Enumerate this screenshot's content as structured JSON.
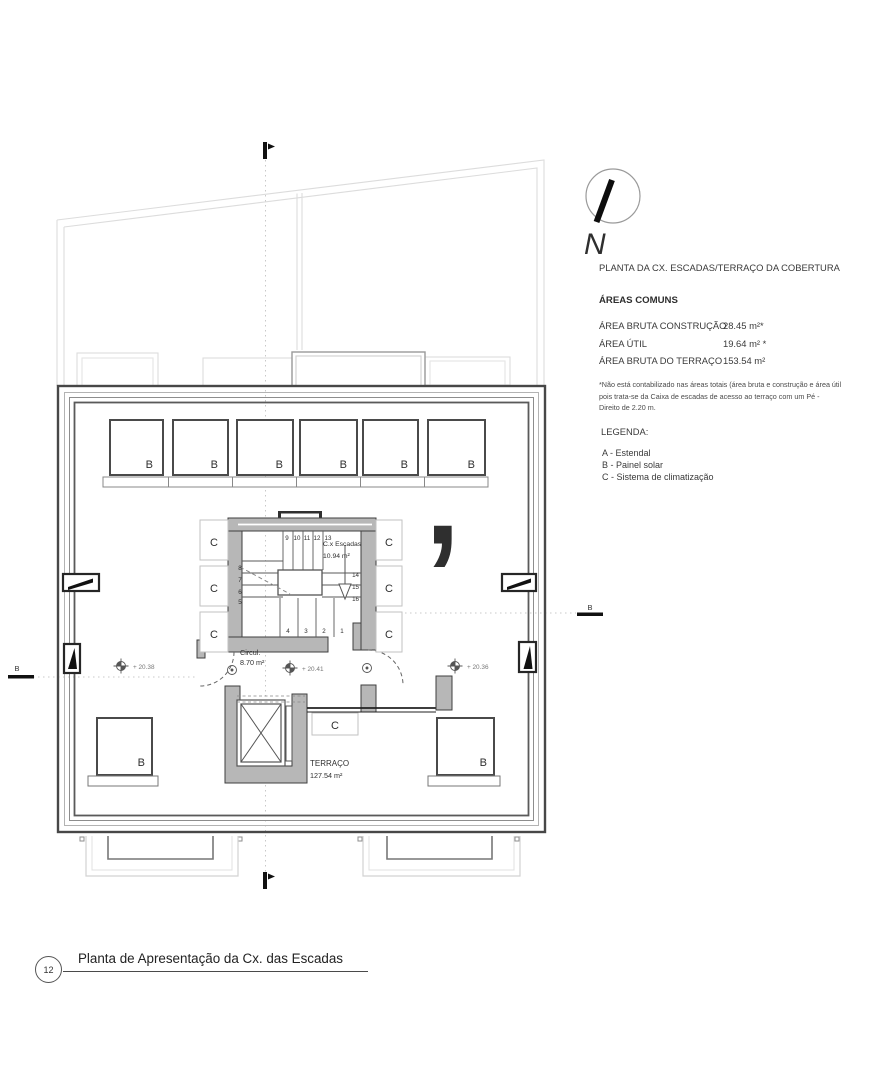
{
  "sheet": {
    "number": "12",
    "title": "Planta de Apresentação da Cx. das Escadas"
  },
  "north": {
    "label": "N"
  },
  "watermark": {
    "glyph": "’"
  },
  "info_panel": {
    "title": "PLANTA DA CX. ESCADAS/TERRAÇO DA COBERTURA",
    "areas_heading": "ÁREAS COMUNS",
    "areas": [
      {
        "label": "ÁREA BRUTA CONSTRUÇÃO",
        "value": "28.45 m²*"
      },
      {
        "label": "ÁREA ÚTIL",
        "value": "19.64 m² *"
      },
      {
        "label": "ÁREA BRUTA DO TERRAÇO",
        "value": "153.54 m²"
      }
    ],
    "footnote": "*Não está contabilizado nas áreas totais (área bruta e construção e área útil pois trata-se da Caixa de escadas de acesso ao terraço com um Pé - Direito de 2.20 m.",
    "legend_heading": "LEGENDA:",
    "legend": [
      "A - Estendal",
      "B - Painel solar",
      "C - Sistema de climatização"
    ]
  },
  "plan": {
    "section_label": "B",
    "labels": {
      "solar_panel": "B",
      "climate_unit": "C"
    },
    "rooms": {
      "stairs": {
        "name": "C.x Escadas",
        "area": "10.94 m²"
      },
      "circulation": {
        "name": "Circul.",
        "area": "8.70 m²"
      },
      "terrace": {
        "name": "TERRAÇO",
        "area": "127.54 m²"
      }
    },
    "levels": [
      "+ 20.38",
      "+ 20.41",
      "+ 20.36"
    ],
    "steps": {
      "top": [
        "9",
        "10",
        "11",
        "12",
        "13"
      ],
      "right": [
        "14",
        "15",
        "16"
      ],
      "bottom": [
        "4",
        "3",
        "2",
        "1"
      ],
      "left": [
        "8",
        "7",
        "6",
        "5"
      ]
    }
  },
  "colors": {
    "gold": "#c7ad74",
    "line_dark": "#3f3f3f",
    "line_light": "#d9d9d9",
    "wall_fill": "#b7b7b7"
  }
}
